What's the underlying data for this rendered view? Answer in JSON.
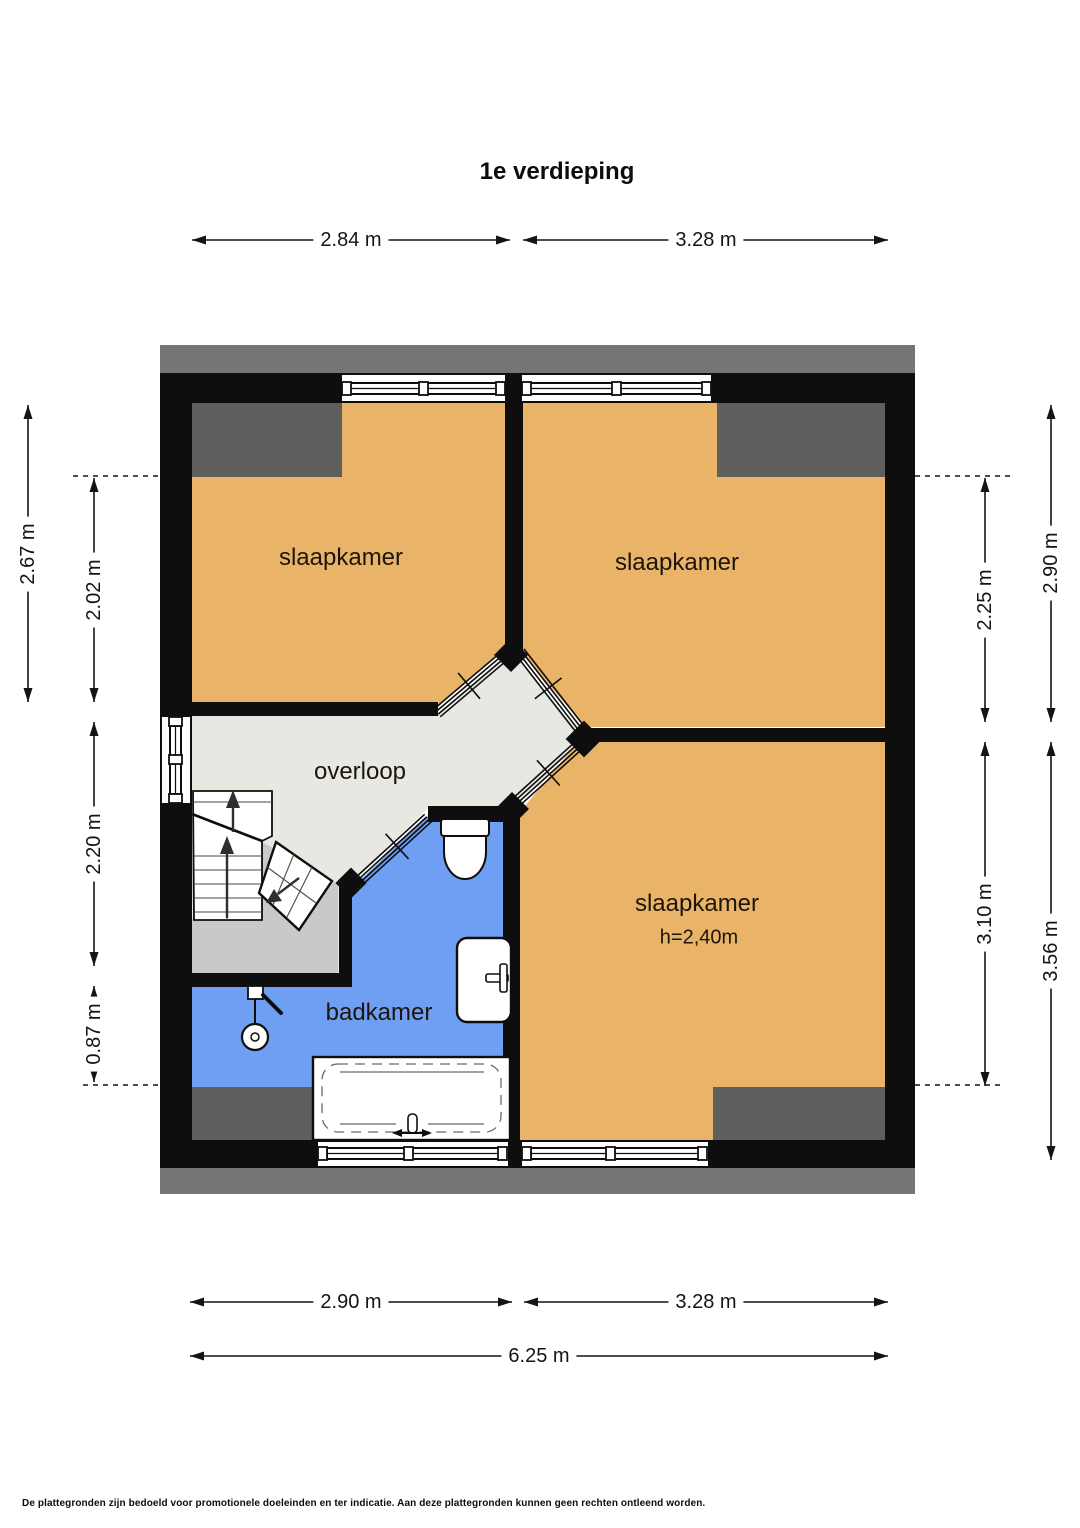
{
  "title": "1e verdieping",
  "rooms": {
    "bedroom_top_left": {
      "label": "slaapkamer"
    },
    "bedroom_top_right": {
      "label": "slaapkamer"
    },
    "bedroom_bottom": {
      "label": "slaapkamer",
      "height_note": "h=2,40m"
    },
    "landing": {
      "label": "overloop"
    },
    "bathroom": {
      "label": "badkamer"
    }
  },
  "dimensions": {
    "top_left": "2.84 m",
    "top_right": "3.28 m",
    "left_outer": "2.67 m",
    "left_inner_top": "2.02 m",
    "left_inner_middle": "2.20 m",
    "left_inner_bottom": "0.87 m",
    "right_outer_top": "2.90 m",
    "right_inner_top": "2.25 m",
    "right_inner_bottom": "3.10 m",
    "right_outer_bottom": "3.56 m",
    "bottom_left": "2.90 m",
    "bottom_right": "3.28 m",
    "bottom_total": "6.25 m"
  },
  "colors": {
    "bedroom": "#e9b468",
    "bathroom": "#6f9ff2",
    "landing": "#e8e8e3",
    "understairs": "#c9c9c8",
    "low_headroom": "#5f5f5f",
    "roof_band": "#757575",
    "wall": "#0e0e0e"
  },
  "footer": "De plattegronden zijn bedoeld voor promotionele doeleinden en ter indicatie. Aan deze plattegronden kunnen geen rechten ontleend worden."
}
